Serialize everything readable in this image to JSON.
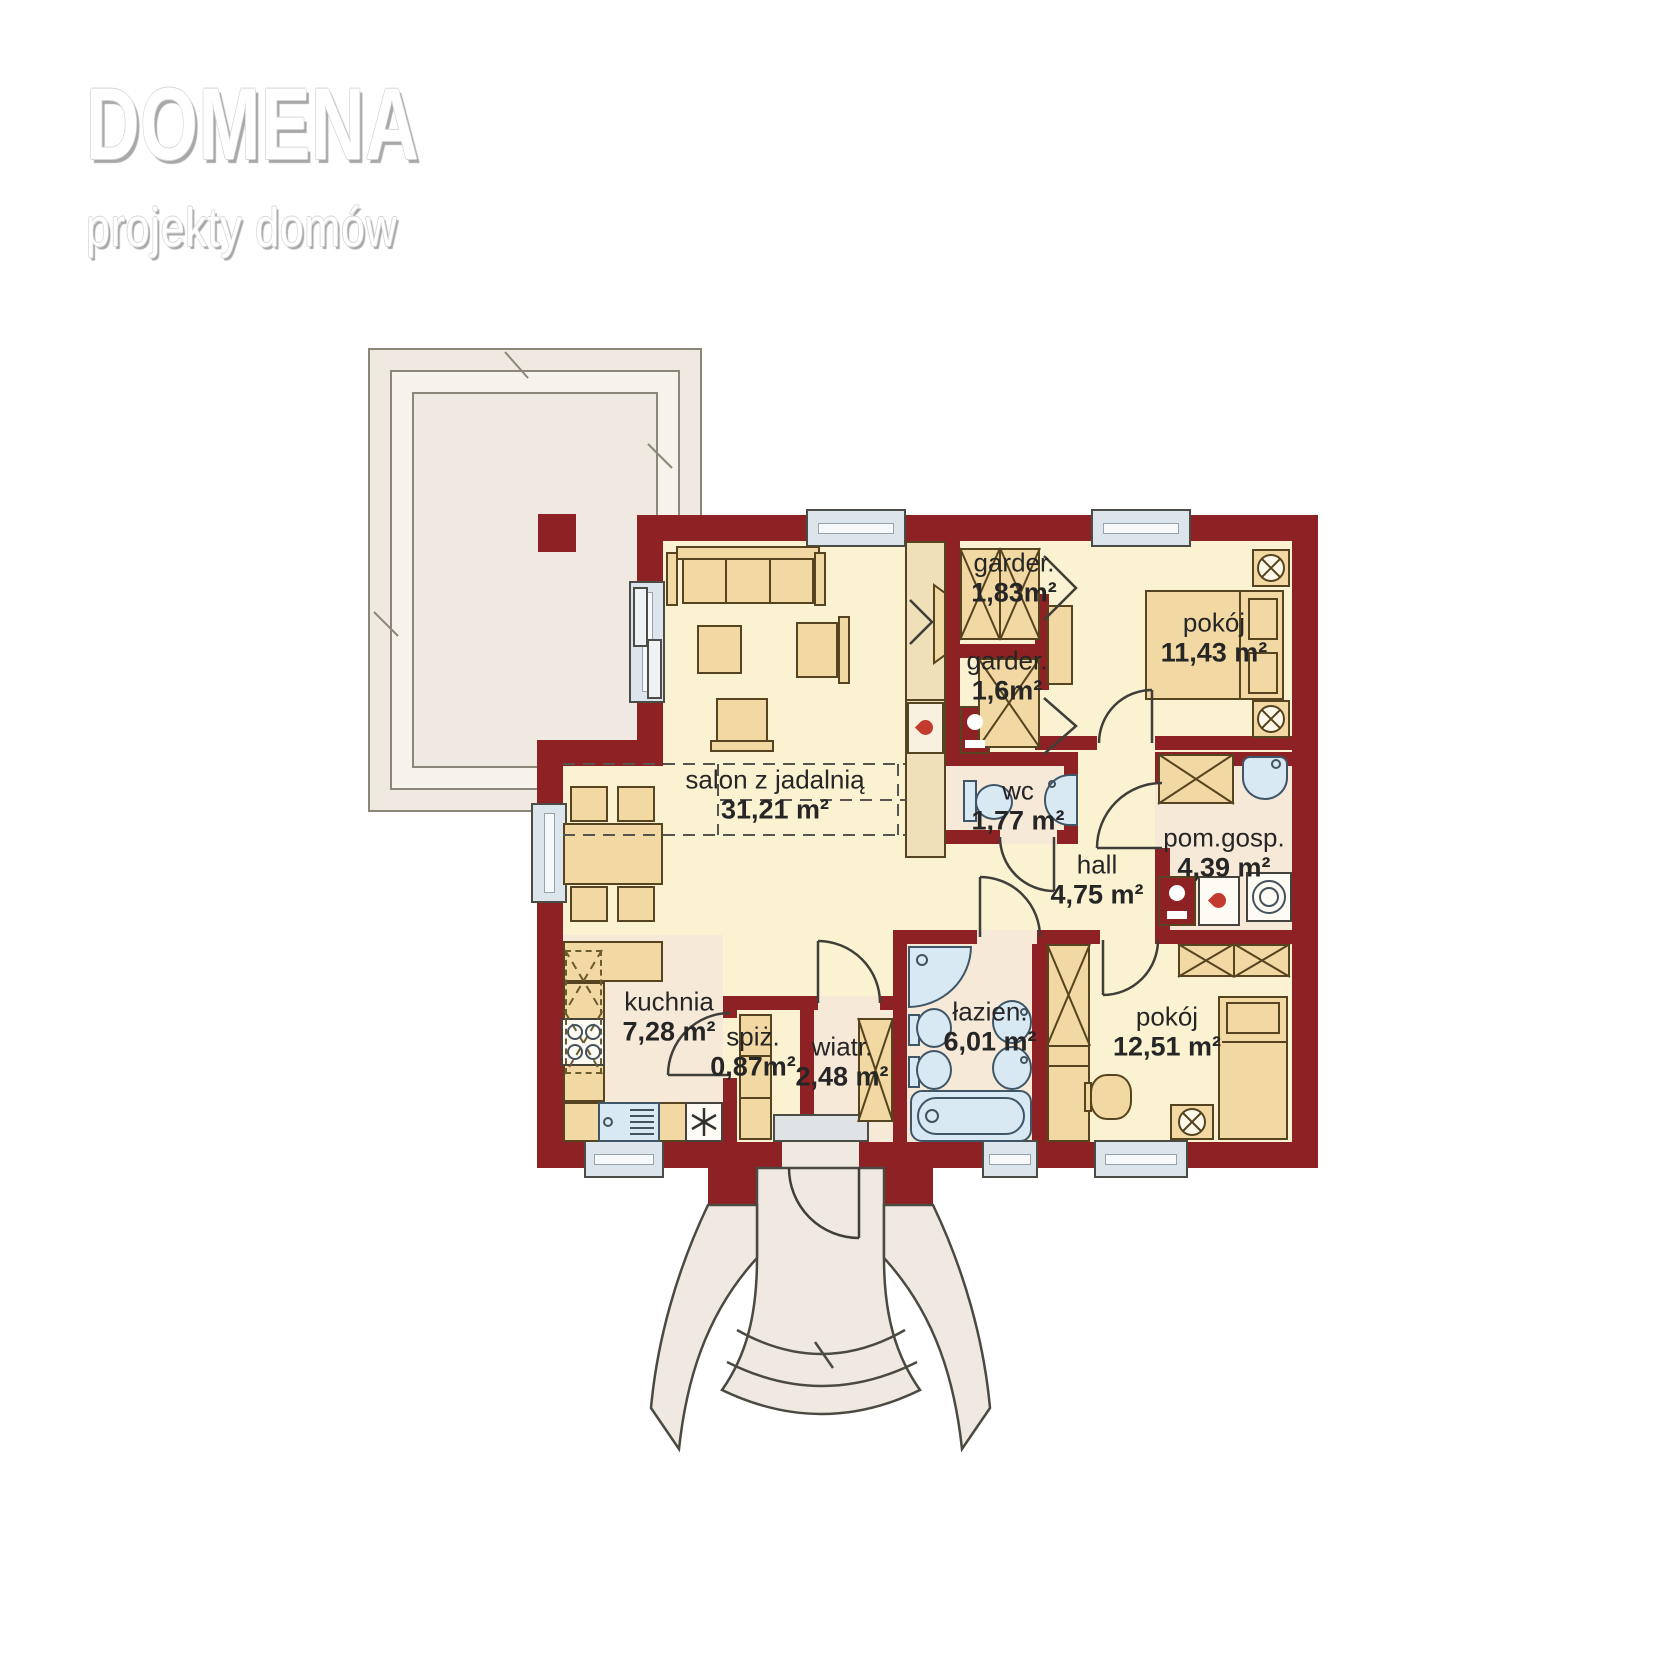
{
  "logo": {
    "title": "DOMENA",
    "subtitle": "projekty domów"
  },
  "rooms": {
    "salon": {
      "name": "salon z jadalnią",
      "area": "31,21 m²"
    },
    "garder1": {
      "name": "garder.",
      "area": "1,83m²"
    },
    "garder2": {
      "name": "garder.",
      "area": "1,6m²"
    },
    "pokoj1": {
      "name": "pokój",
      "area": "11,43 m²"
    },
    "wc": {
      "name": "wc",
      "area": "1,77 m²"
    },
    "hall": {
      "name": "hall",
      "area": "4,75 m²"
    },
    "pomgosp": {
      "name": "pom.gosp.",
      "area": "4,39 m²"
    },
    "kuchnia": {
      "name": "kuchnia",
      "area": "7,28 m²"
    },
    "spiz": {
      "name": "spiż.",
      "area": "0,87m²"
    },
    "wiatr": {
      "name": "wiatr.",
      "area": "2,48 m²"
    },
    "lazienka": {
      "name": "łazien.",
      "area": "6,01 m²"
    },
    "pokoj2": {
      "name": "pokój",
      "area": "12,51 m²"
    }
  },
  "colors": {
    "wall": "#8d2123",
    "floor": "#fbf2d2",
    "floor_alt": "#f7e9d8",
    "furniture": "#f2d8a2",
    "fixture": "#d9e9f3",
    "terrace": "#efe9e1",
    "logo_shadow": "#a8a8a8"
  }
}
